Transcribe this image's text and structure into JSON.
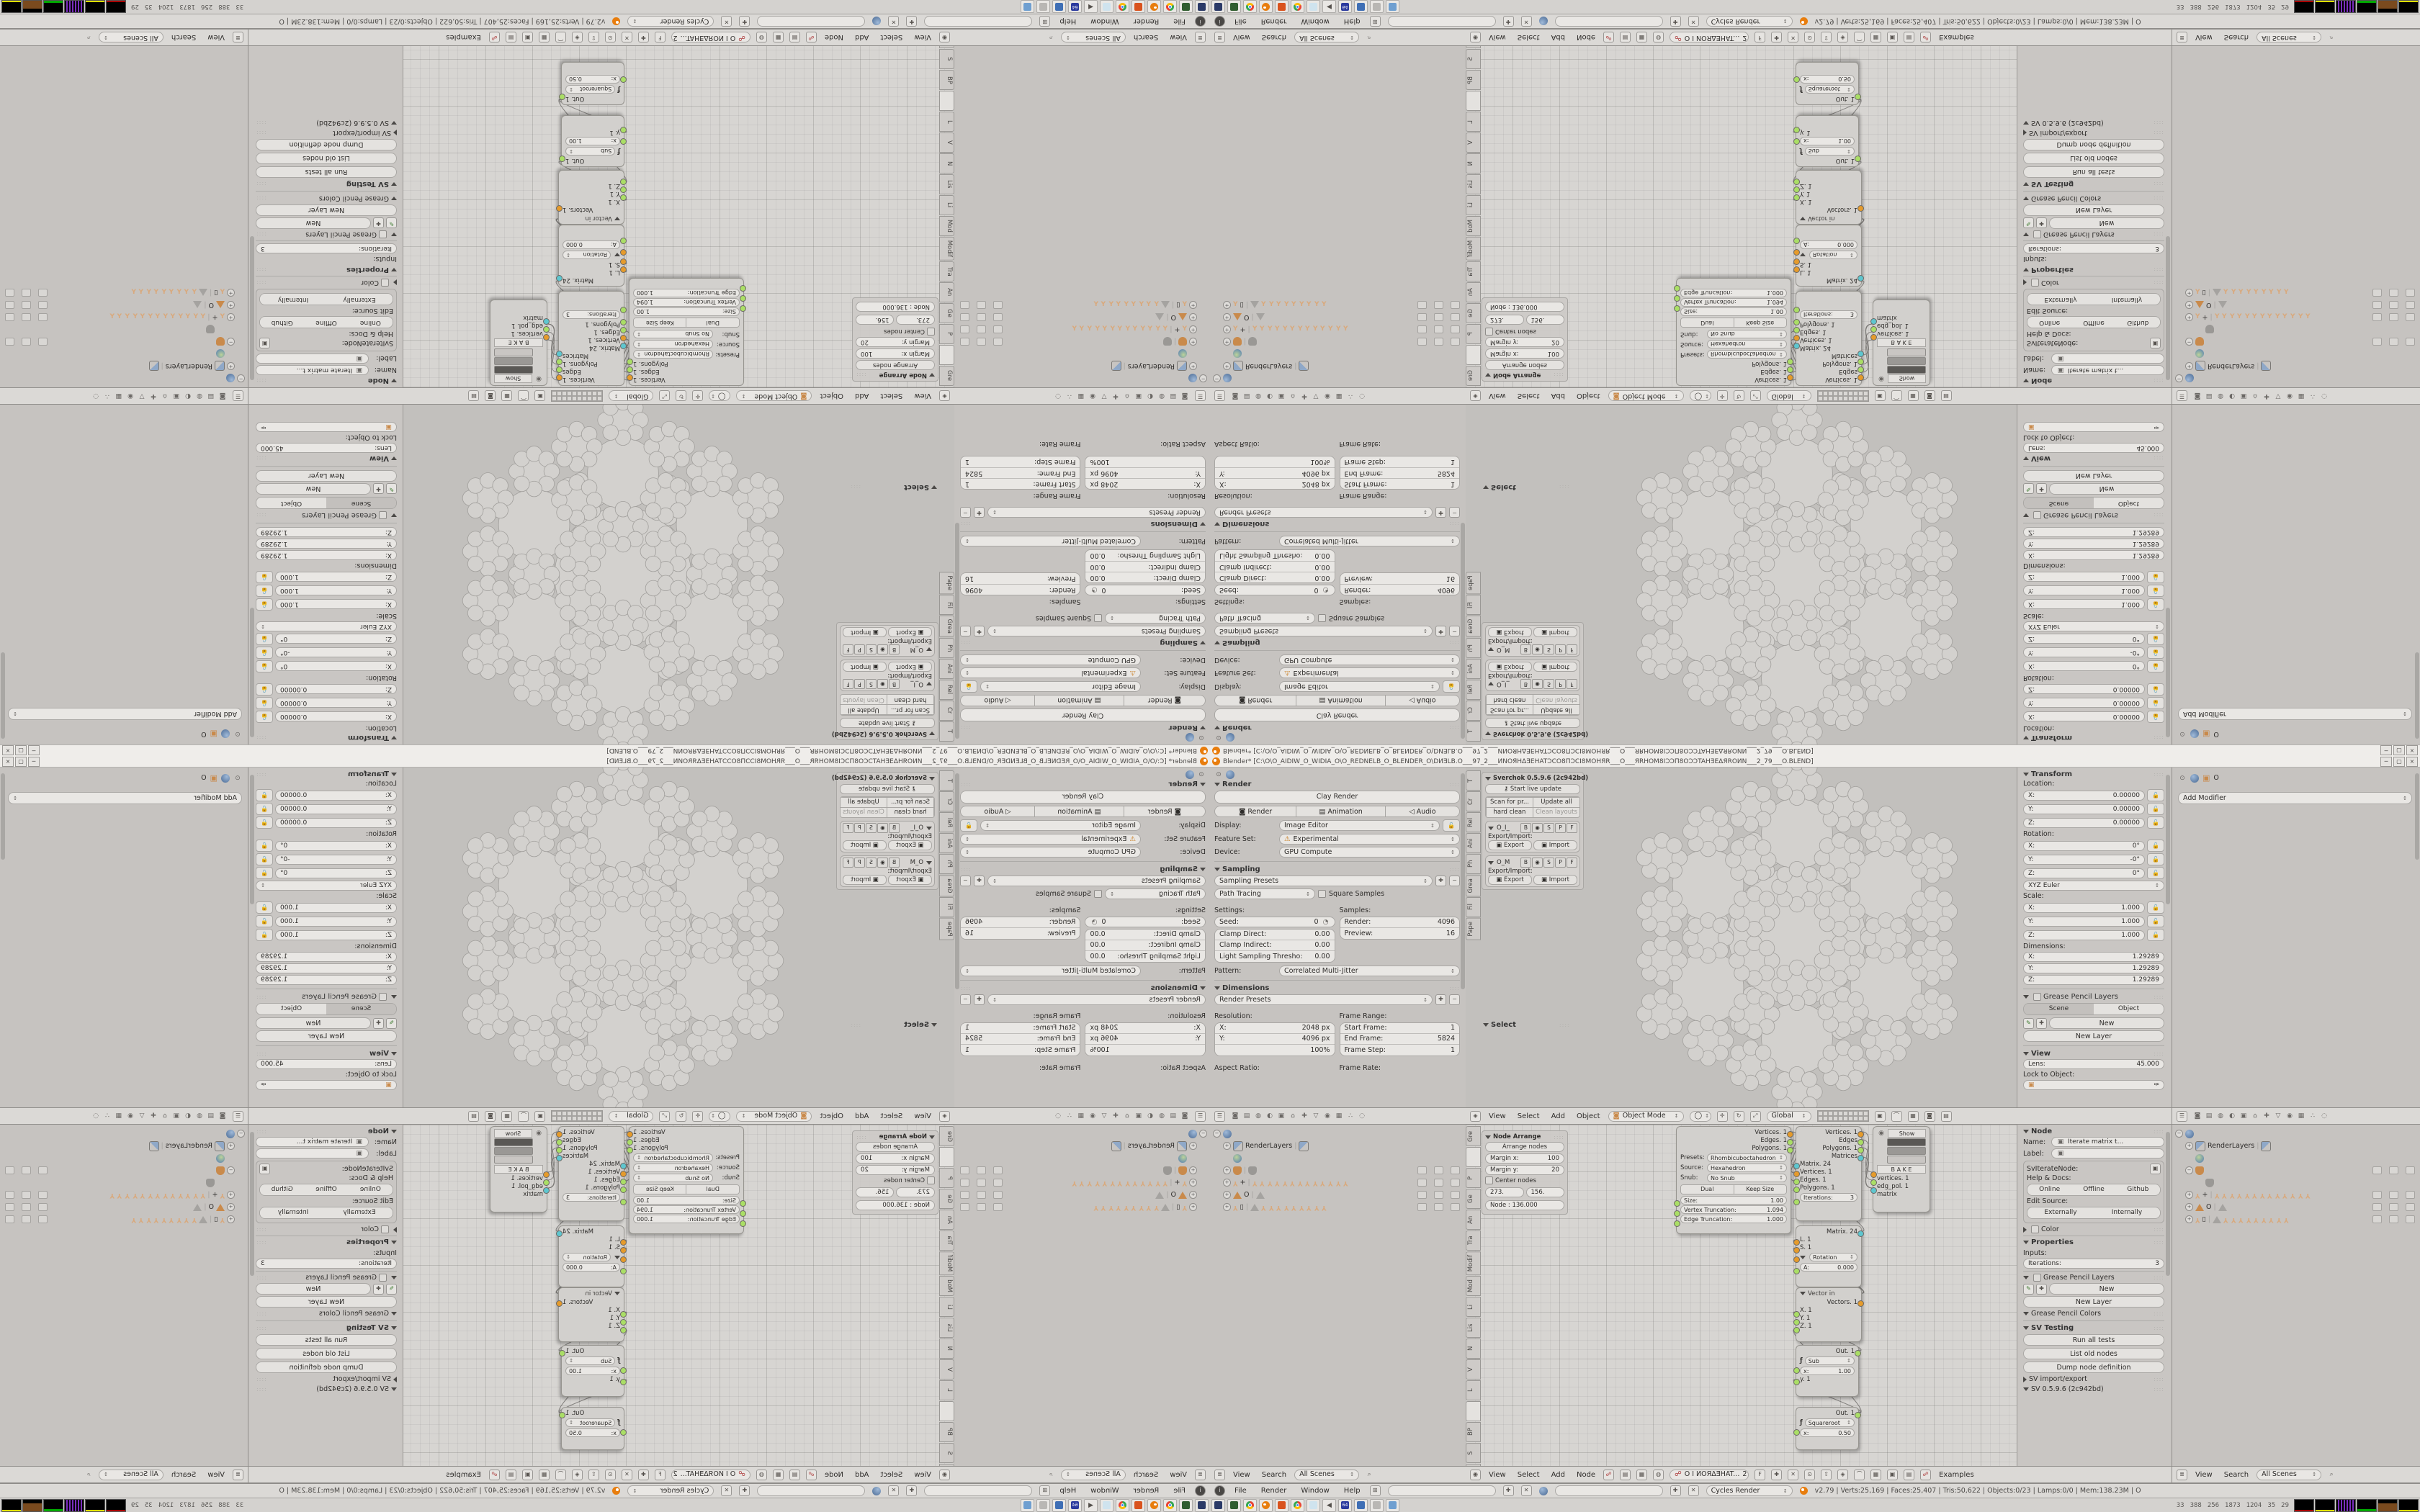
{
  "window": {
    "title": "Blender* [C:\\O\\O_AIDIW_O_WIDIA_O\\O_REDNELB_O_BLENDER_O\\DИƎLB.O___97_2___ИNOЯHΔƎEHATƆCO8ΠƆCI8MOHЯR___O___ЯRHOM8IƆƆΠ8OƆƆTAHƎEΔЯROИN___2_79___O.BLEND]",
    "min": "─",
    "restore": "▢",
    "close": "×"
  },
  "props_left": {
    "render": {
      "title": "Render",
      "clay": "Clay Render",
      "render_btn": "Render",
      "anim_btn": "Animation",
      "audio_btn": "Audio",
      "display_label": "Display:",
      "display_value": "Image Editor",
      "feature_label": "Feature Set:",
      "feature_warn": "⚠",
      "feature_value": "Experimental",
      "device_label": "Device:",
      "device_value": "GPU Compute"
    },
    "sampling": {
      "title": "Sampling",
      "presets": "Sampling Presets",
      "integrator": "Path Tracing",
      "square": "Square Samples",
      "settings": "Settings:",
      "seed": "Seed:",
      "seed_v": "0",
      "clamp_d": "Clamp Direct:",
      "clamp_d_v": "0.00",
      "clamp_i": "Clamp Indirect:",
      "clamp_i_v": "0.00",
      "light_t": "Light Sampling Thresho:",
      "light_t_v": "0.00",
      "samples": "Samples:",
      "render_s": "Render:",
      "render_s_v": "4096",
      "preview_s": "Preview:",
      "preview_s_v": "16",
      "pattern": "Pattern:",
      "pattern_v": "Correlated Multi-Jitter"
    },
    "dimensions": {
      "title": "Dimensions",
      "presets": "Render Presets",
      "res": "Resolution:",
      "x": "X:",
      "x_v": "2048 px",
      "y": "Y:",
      "y_v": "4096 px",
      "pct": "100%",
      "fr": "Frame Range:",
      "sf": "Start Frame:",
      "sf_v": "1",
      "ef": "End Frame:",
      "ef_v": "5824",
      "fstep": "Frame Step:",
      "fstep_v": "1",
      "aspect": "Aspect Ratio:",
      "frate": "Frame Rate:"
    },
    "header_icons": [
      {
        "name": "render-tab-icon",
        "t": "◙"
      },
      {
        "name": "render-layers-tab-icon",
        "t": "▤"
      },
      {
        "name": "scene-tab-icon",
        "t": "◍"
      },
      {
        "name": "world-tab-icon",
        "t": "◐"
      },
      {
        "name": "object-tab-icon",
        "t": "▣"
      },
      {
        "name": "constraints-tab-icon",
        "t": "⌂"
      },
      {
        "name": "modifiers-tab-icon",
        "t": "✚"
      },
      {
        "name": "data-tab-icon",
        "t": "▽"
      },
      {
        "name": "material-tab-icon",
        "t": "◉"
      },
      {
        "name": "texture-tab-icon",
        "t": "▦"
      },
      {
        "name": "particles-tab-icon",
        "t": "∴"
      },
      {
        "name": "physics-tab-icon",
        "t": "◌"
      }
    ]
  },
  "shelf3d": {
    "tabs": [
      "T",
      "Cr",
      "Rel",
      "Ani",
      "Ph",
      "Grea",
      "Fil",
      "Pape"
    ],
    "panel_title": "Sverchok 0.5.9.6 (2c942bd)",
    "live": "Start live update",
    "scan": "Scan for pr...",
    "update": "Update all",
    "hard": "hard clean",
    "clean": "Clean layouts",
    "g1": "O_I_",
    "g2": "O_M",
    "flag_b": "B",
    "flag_eye": "◉",
    "flag_s": "S",
    "flag_p": "P",
    "flag_f": "F",
    "exp_lbl": "Export/Import:",
    "export": "Export",
    "import": "Import",
    "select_title": "Select"
  },
  "viewport_header": {
    "menus": [
      "View",
      "Select",
      "Add",
      "Object"
    ],
    "mode": "Object Mode",
    "orient": "Global"
  },
  "transform_panel": {
    "title": "Transform",
    "loc": "Location:",
    "lx": "X:",
    "lx_v": "0.00000",
    "ly": "Y:",
    "ly_v": "0.00000",
    "lz": "Z:",
    "lz_v": "0.00000",
    "rot": "Rotation:",
    "rx_v": "0°",
    "ry_v": "-0°",
    "rz_v": "0°",
    "euler": "XYZ Euler",
    "scale": "Scale:",
    "s_v": "1.000",
    "dim": "Dimensions:",
    "d_v": "1.29289",
    "gp": "Grease Pencil Layers",
    "scene": "Scene",
    "object": "Object",
    "new": "New",
    "new_layer": "New Layer",
    "view": "View",
    "lens": "Lens:",
    "lens_v": "45.000",
    "lock": "Lock to Object:"
  },
  "props_right": {
    "obj": "O",
    "add_modifier": "Add Modifier"
  },
  "outliner": {
    "root_label": "",
    "renderlayers": "RenderLayers",
    "arm_plus": "+",
    "mesh_o": "O",
    "arm_sq": "▯",
    "bones13": [
      "Y",
      "Y",
      "Y",
      "Y",
      "Y",
      "Y",
      "Y",
      "Y",
      "Y",
      "Y",
      "Y",
      "Y",
      "Y"
    ],
    "bones9": [
      "Y",
      "Y",
      "Y",
      "Y",
      "Y",
      "Y",
      "Y",
      "Y",
      "Y"
    ],
    "header_menus": [
      "View",
      "Search"
    ],
    "scenes": "All Scenes"
  },
  "node_shelf": {
    "tabs": [
      "Gre",
      "",
      "P",
      "Ge",
      "An",
      "Tra",
      "Modif",
      "Mod",
      "Li",
      "Lis",
      "N",
      "V",
      "L",
      "",
      "BP",
      "S",
      "L",
      "N",
      "Bet",
      "G"
    ],
    "arrange_title": "Node Arrange",
    "arrange_btn": "Arrange nodes",
    "mx": "Margin x:",
    "mx_v": "100",
    "my": "Margin y:",
    "my_v": "20",
    "center": "Center nodes",
    "f1": "273.",
    "f2": "156.",
    "node_f": "Node : 136.000"
  },
  "nodes": {
    "gen": {
      "out1": "Vertices. 1",
      "out2": "Edges. 1",
      "out3": "Polygons. 1",
      "presets_l": "Presets:",
      "presets_v": "Rhombicuboctahedron",
      "source_l": "Source:",
      "source_v": "Hexahedron",
      "snub_l": "Snub:",
      "snub_v": "No Snub",
      "dual": "Dual",
      "keep": "Keep Size",
      "size": "Size:",
      "size_v": "1.00",
      "vt": "Vertex Truncation:",
      "vt_v": "1.094",
      "et": "Edge Truncation:",
      "et_v": "1.000"
    },
    "iter": {
      "out1": "Vertices. 1",
      "out2": "Edges",
      "out3": "Polygons. 1",
      "out4": "Matrices",
      "in1": "Matrix. 24",
      "in2": "Vertices. 1",
      "in3": "Edges. 1",
      "in4": "Polygons. 1",
      "iterations": "Iterations:",
      "iter_v": "3"
    },
    "viewer": {
      "show": "Show",
      "bake": "B A K E",
      "in1": "vertices. 1",
      "in2": "edg_pol. 1",
      "in3": "matrix"
    },
    "matrix": {
      "out": "Matrix. 24",
      "l": "L. 1",
      "s": "S. 1",
      "rot": "Rotation",
      "a": "A:",
      "a_v": "0.000"
    },
    "vector": {
      "title": "Vector in",
      "out": "Vectors. 1",
      "x": "X. 1",
      "y": "Y. 1",
      "z": "Z. 1"
    },
    "sub": {
      "out": "Out. 1",
      "op": "Sub",
      "x": "x:",
      "x_v": "1.00",
      "y": "y. 1"
    },
    "sqrt": {
      "out": "Out. 1",
      "op": "Squareroot",
      "x": "x:",
      "x_v": "0.50"
    }
  },
  "node_panel": {
    "title": "Node",
    "name_l": "Name:",
    "name_v": "Iterate matrix t...",
    "label_l": "Label:",
    "label_v": "",
    "cls": "SvIterateNode:",
    "help": "Help & Docs:",
    "online": "Online",
    "offline": "Offline",
    "github": "Github",
    "edit_src": "Edit Source:",
    "ext": "Externally",
    "int": "Internally",
    "color": "Color",
    "properties": "Properties",
    "inputs": "Inputs:",
    "iterations": "Iterations:",
    "iter_v": "3",
    "gp": "Grease Pencil Layers",
    "new": "New",
    "new_layer": "New Layer",
    "gpc": "Grease Pencil Colors",
    "svt": "SV Testing",
    "run": "Run all tests",
    "list": "List old nodes",
    "dump": "Dump node definition",
    "impexp": "SV import/export",
    "ver": "SV 0.5.9.6 (2c942bd)"
  },
  "node_header": {
    "menus": [
      "View",
      "Select",
      "Add",
      "Node"
    ],
    "tree": "O I ИOЯΔƎHAT...",
    "num": "2",
    "f": "F",
    "examples": "Examples"
  },
  "info_bar": {
    "menus": [
      "File",
      "Render",
      "Window",
      "Help"
    ],
    "engine": "Cycles Render",
    "stats": "v2.79 | Verts:25,169 | Faces:25,407 | Tris:50,622 | Objects:0/23 | Lamps:0/0 | Mem:138.23M | O"
  },
  "taskbar": {
    "icons": [
      {
        "name": "display-settings-icon",
        "k": "sq",
        "c": "#2b3a67"
      },
      {
        "name": "scanner-icon",
        "k": "sq",
        "c": "#2f5d2f"
      },
      {
        "name": "chrome-icon",
        "k": "chrome"
      },
      {
        "name": "blender-icon",
        "k": "bl"
      },
      {
        "name": "spiral-app-icon",
        "k": "sq",
        "c": "#d9531e"
      },
      {
        "name": "chrome-icon",
        "k": "chrome"
      },
      {
        "name": "notepad-icon",
        "k": "sq",
        "c": "#cfe3ee"
      },
      {
        "name": "volume-icon",
        "k": "t",
        "t": "◀"
      },
      {
        "name": "save-64-icon",
        "k": "sq64",
        "c": "#2b3a9e"
      },
      {
        "name": "image-viewer-icon",
        "k": "sq",
        "c": "#3f6fb5"
      },
      {
        "name": "calculator-icon",
        "k": "sq",
        "c": "#b9b7b4"
      },
      {
        "name": "window-app-icon",
        "k": "sq",
        "c": "#6f9fd0"
      }
    ],
    "numbers": [
      "33",
      "388",
      "256",
      "1873",
      "1204",
      "35",
      "29"
    ],
    "graphs": [
      "g1",
      "g2",
      "g3",
      "g4",
      "g5",
      "g6"
    ]
  },
  "accent_colors": {
    "socket_orange": "#e59b2c",
    "socket_green": "#aade66",
    "socket_cyan": "#5ec6cf",
    "blender_orange": "#e87d0d"
  }
}
